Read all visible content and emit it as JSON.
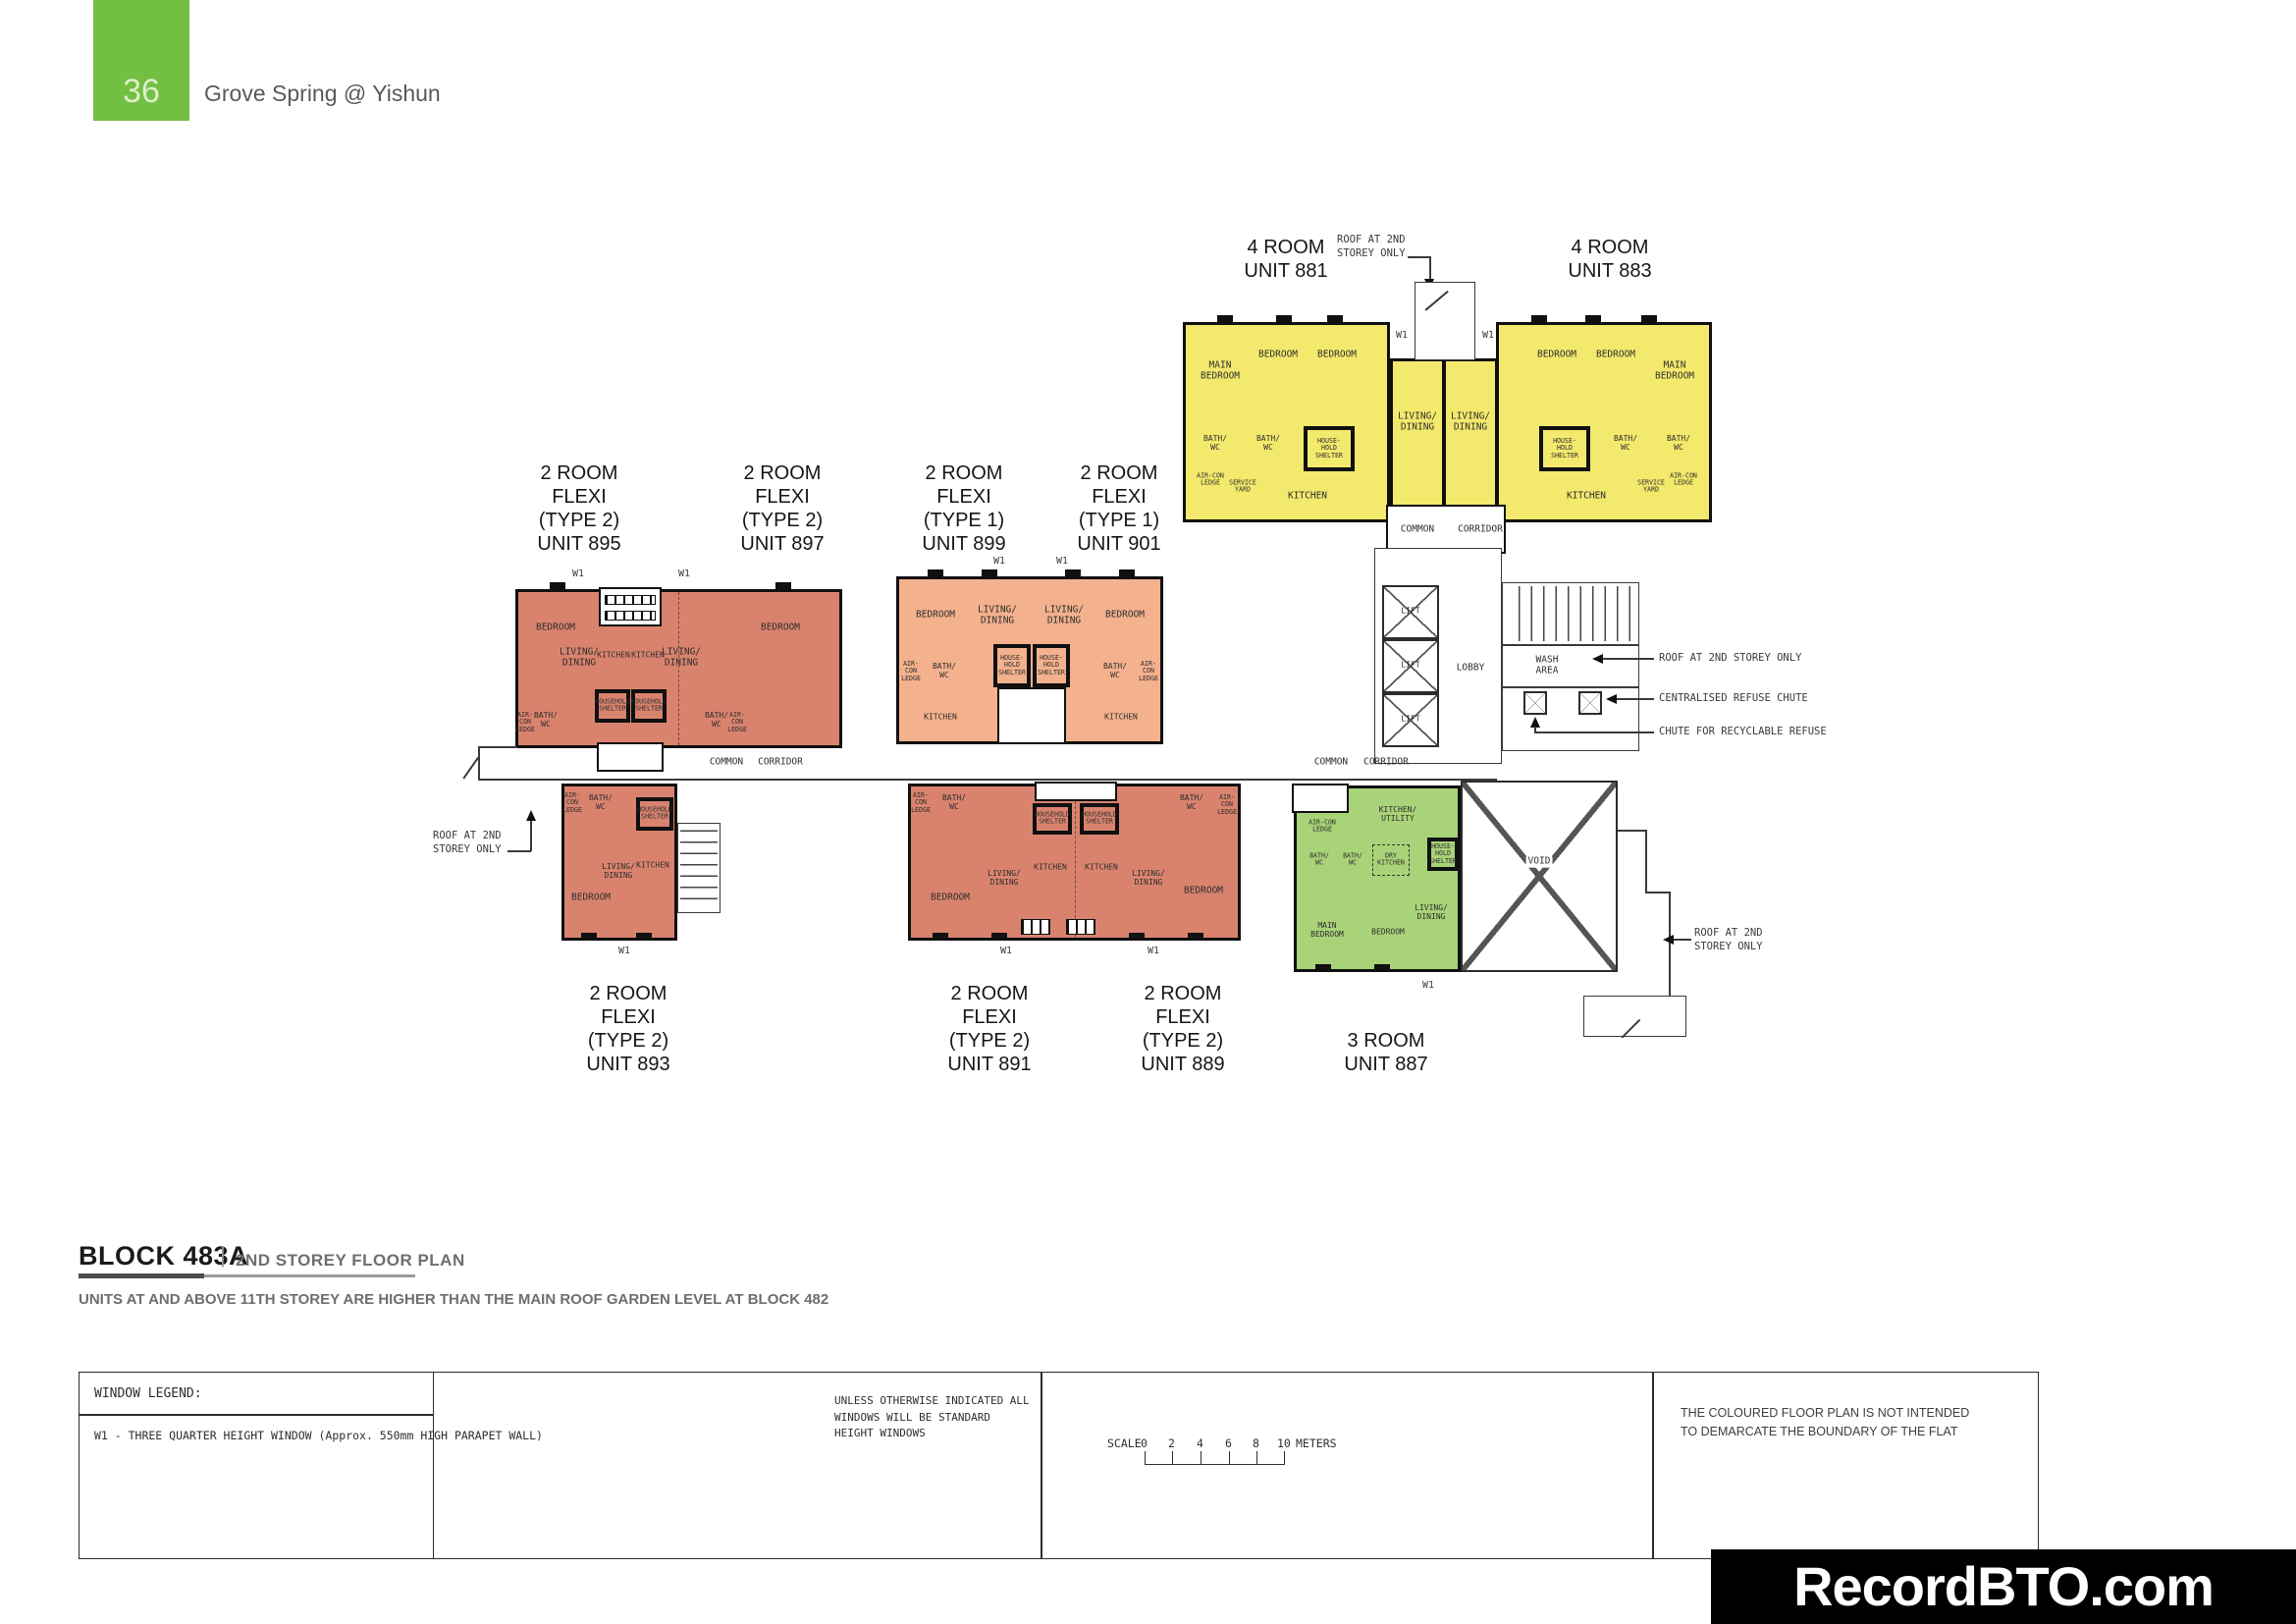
{
  "page": {
    "number": "36",
    "title": "Grove Spring @ Yishun"
  },
  "plan": {
    "unit_labels": {
      "u881": "4 ROOM\nUNIT 881",
      "u883": "4 ROOM\nUNIT 883",
      "u895": "2 ROOM\nFLEXI\n(TYPE 2)\nUNIT 895",
      "u897": "2 ROOM\nFLEXI\n(TYPE 2)\nUNIT 897",
      "u899": "2 ROOM\nFLEXI\n(TYPE 1)\nUNIT 899",
      "u901": "2 ROOM\nFLEXI\n(TYPE 1)\nUNIT 901",
      "u893": "2 ROOM\nFLEXI\n(TYPE 2)\nUNIT 893",
      "u891": "2 ROOM\nFLEXI\n(TYPE 2)\nUNIT 891",
      "u889": "2 ROOM\nFLEXI\n(TYPE 2)\nUNIT 889",
      "u887": "3 ROOM\nUNIT 887"
    },
    "rooms": {
      "main_bedroom": "MAIN\nBEDROOM",
      "bedroom": "BEDROOM",
      "living_dining": "LIVING/\nDINING",
      "bath_wc": "BATH/\nWC",
      "household_shelter": "HOUSE-\nHOLD\nSHELTER",
      "household_shelter_wide": "HOUSEHOLD\nSHELTER",
      "kitchen": "KITCHEN",
      "kitchen_utility": "KITCHEN/\nUTILITY",
      "dry_kitchen": "DRY\nKITCHEN",
      "aircon_ledge": "AIR-\nCON\nLEDGE",
      "aircon_ledge_wide": "AIR-CON\nLEDGE",
      "service_yard": "SERVICE\nYARD",
      "lift": "LIFT",
      "lobby": "LOBBY",
      "wash_area": "WASH\nAREA",
      "void": "VOID",
      "w1": "W1",
      "common": "COMMON",
      "corridor": "CORRIDOR"
    },
    "annotations": {
      "roof_top": "ROOF AT 2ND\nSTOREY ONLY",
      "roof_left": "ROOF AT 2ND\nSTOREY ONLY",
      "roof_right": "ROOF AT 2ND STOREY ONLY",
      "refuse_chute": "CENTRALISED REFUSE CHUTE",
      "recyclable_chute": "CHUTE FOR RECYCLABLE REFUSE",
      "roof_bottom_right": "ROOF AT 2ND\nSTOREY ONLY"
    }
  },
  "footer": {
    "block_title": "BLOCK 483A",
    "divider": "|",
    "plan_title": "2ND STOREY FLOOR PLAN",
    "note": "UNITS AT AND ABOVE 11TH STOREY ARE HIGHER THAN THE MAIN ROOF GARDEN LEVEL AT BLOCK 482",
    "legend": {
      "title": "WINDOW LEGEND:",
      "w1_desc": "W1 - THREE QUARTER HEIGHT WINDOW (Approx. 550mm HIGH PARAPET WALL)",
      "windows_note": "UNLESS OTHERWISE INDICATED ALL WINDOWS WILL BE STANDARD HEIGHT WINDOWS",
      "scale_label": "SCALE",
      "scale_ticks": [
        "0",
        "2",
        "4",
        "6",
        "8",
        "10"
      ],
      "scale_unit": "METERS",
      "boundary_note": "THE COLOURED FLOOR PLAN IS NOT INTENDED\nTO DEMARCATE THE BOUNDARY OF THE FLAT"
    },
    "watermark": "RecordBTO.com"
  },
  "colors": {
    "header_green": "#72bf44",
    "four_room_yellow": "#f3e96c",
    "two_room_type2_salmon": "#d9836e",
    "two_room_type1_peach": "#f4b18d",
    "three_room_green": "#a9d378",
    "wall": "#101010"
  }
}
